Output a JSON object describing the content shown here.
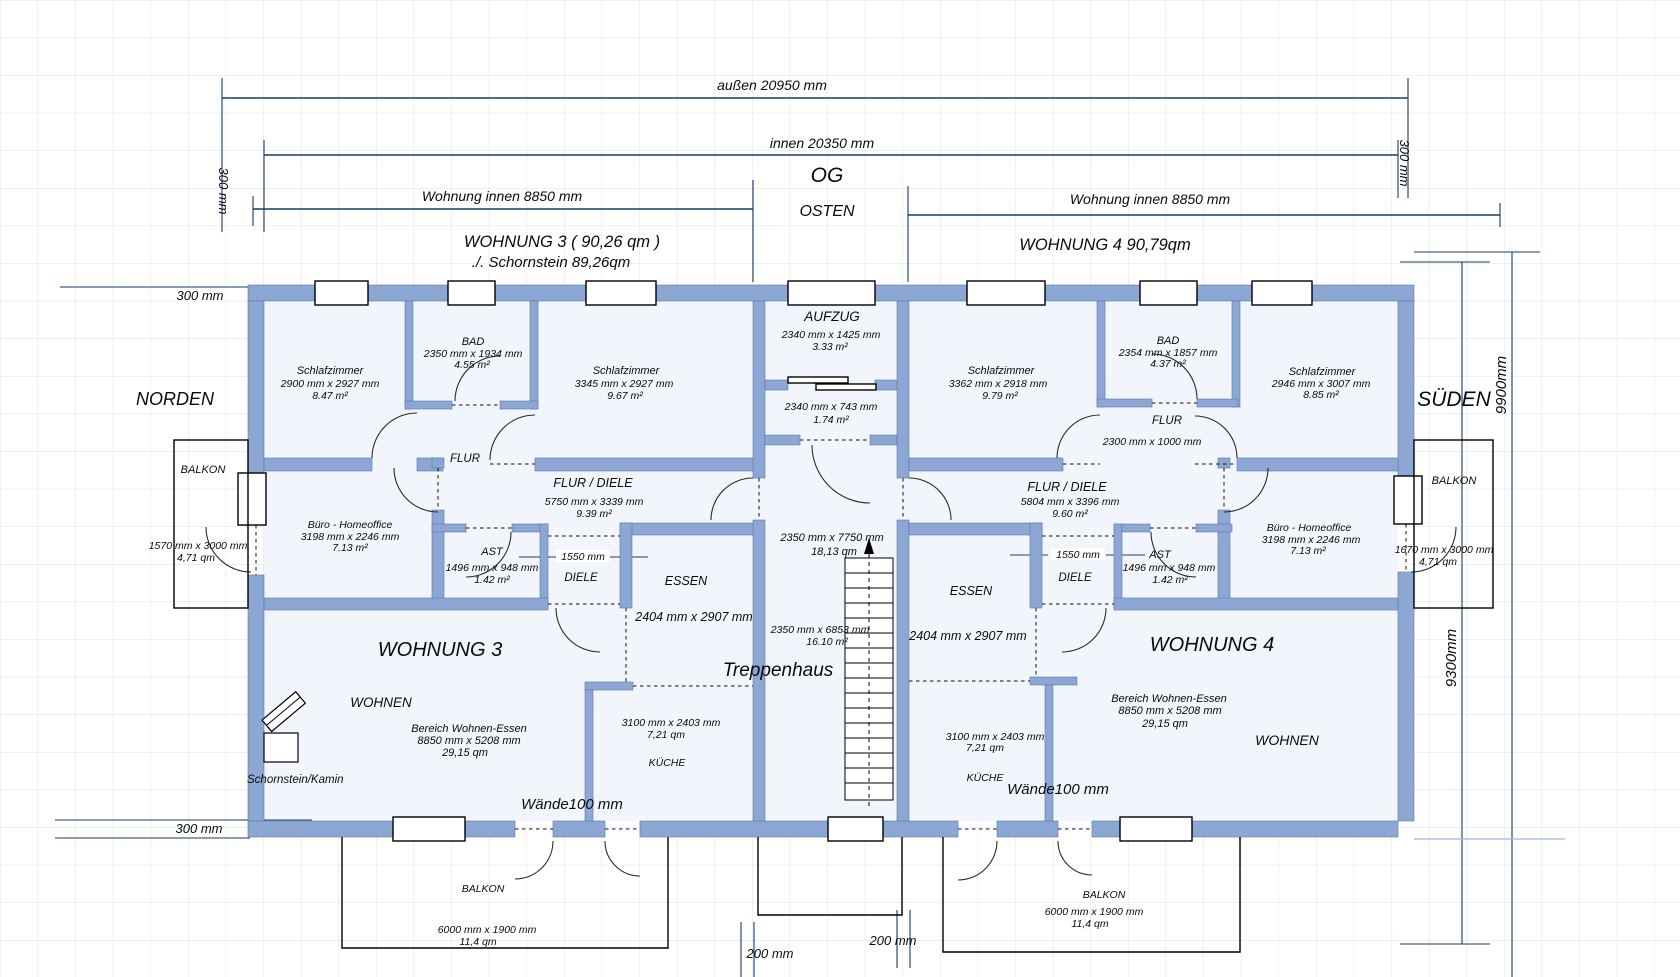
{
  "header": {
    "outer_width": "außen 20950 mm",
    "inner_width": "innen  20350 mm",
    "floor": "OG",
    "east": "OSTEN",
    "north": "NORDEN",
    "south": "SÜDEN",
    "apartment_inner_left": "Wohnung innen 8850 mm",
    "apartment_inner_right": "Wohnung innen 8850 mm",
    "apt3_title": "WOHNUNG   3    ( 90,26 qm )",
    "apt3_subtitle": "./.  Schornstein    89,26qm",
    "apt4_title": "WOHNUNG  4    90,79qm",
    "wall_300_left": "300 mm",
    "wall_300_right": "300 mm",
    "wall_300_topleft": "300 mm",
    "wall_300_bottomleft": "300 mm",
    "total_height": "9900mm",
    "inner_height": "9300mm"
  },
  "core": {
    "elevator": {
      "name": "AUFZUG",
      "size": "2340 mm x 1425 mm",
      "area": "3.33 m²"
    },
    "shaft": {
      "size": "2340 mm x 743 mm",
      "area": "1.74 m²"
    },
    "stairwell": {
      "name": "Treppenhaus",
      "size_outer": "2350 mm x 7750 mm",
      "area_outer": "18,13 qm",
      "size_inner": "2350 mm x 6853 mm",
      "area_inner": "16.10 m²"
    },
    "gap_left": "200 mm",
    "gap_right": "200 mm"
  },
  "apt3": {
    "name": "WOHNUNG 3",
    "bedroom1": {
      "name": "Schlafzimmer",
      "size": "2900 mm x 2927 mm",
      "area": "8.47 m²"
    },
    "bath": {
      "name": "BAD",
      "size": "2350 mm x 1934 mm",
      "area": "4.55 m²"
    },
    "bedroom2": {
      "name": "Schlafzimmer",
      "size": "3345 mm x 2927 mm",
      "area": "9.67 m²"
    },
    "hall": {
      "name": "FLUR"
    },
    "hall_diele": {
      "name": "FLUR / DIELE",
      "size": "5750 mm x 3339 mm",
      "area": "9.39 m²"
    },
    "office": {
      "name": "Büro - Homeoffice",
      "size": "3198 mm x 2246 mm",
      "area": "7.13 m²"
    },
    "ast": {
      "name": "AST",
      "size": "1496 mm x 948 mm",
      "area": "1.42 m²"
    },
    "diele": {
      "name": "DIELE",
      "width": "1550 mm"
    },
    "dining": {
      "name": "ESSEN",
      "size": "2404 mm x 2907 mm"
    },
    "living": {
      "name": "WOHNEN"
    },
    "living_area": {
      "name": "Bereich Wohnen-Essen",
      "size": "8850 mm x 5208 mm",
      "area": "29,15 qm"
    },
    "kitchen": {
      "name": "KÜCHE",
      "size": "3100 mm x 2403 mm",
      "area": "7,21 qm"
    },
    "walls_note": "Wände100 mm",
    "chimney": "Schornstein/Kamin",
    "balcony_side": {
      "name": "BALKON",
      "size": "1570 mm x 3000 mm",
      "area": "4,71 qm"
    },
    "balcony_bottom": {
      "name": "BALKON",
      "size": "6000 mm x 1900 mm",
      "area": "11,4 qm"
    }
  },
  "apt4": {
    "name": "WOHNUNG 4",
    "bedroom1": {
      "name": "Schlafzimmer",
      "size": "3362 mm x 2918 mm",
      "area": "9.79 m²"
    },
    "bath": {
      "name": "BAD",
      "size": "2354 mm x 1857 mm",
      "area": "4.37 m²"
    },
    "bedroom2": {
      "name": "Schlafzimmer",
      "size": "2946 mm x 3007 mm",
      "area": "8.85 m²"
    },
    "hall": {
      "name": "FLUR",
      "size": "2300 mm x 1000 mm"
    },
    "hall_diele": {
      "name": "FLUR / DIELE",
      "size": "5804 mm x 3396 mm",
      "area": "9.60 m²"
    },
    "office": {
      "name": "Büro - Homeoffice",
      "size": "3198 mm x 2246 mm",
      "area": "7.13 m²"
    },
    "ast": {
      "name": "AST",
      "size": "1496 mm x 948 mm",
      "area": "1.42 m²"
    },
    "diele": {
      "name": "DIELE",
      "width": "1550 mm"
    },
    "dining": {
      "name": "ESSEN",
      "size": "2404 mm x 2907 mm"
    },
    "living": {
      "name": "WOHNEN"
    },
    "living_area": {
      "name": "Bereich Wohnen-Essen",
      "size": "8850 mm x 5208 mm",
      "area": "29,15 qm"
    },
    "kitchen": {
      "name": "KÜCHE",
      "size": "3100 mm x 2403 mm",
      "area": "7,21 qm"
    },
    "walls_note": "Wände100 mm",
    "balcony_side": {
      "name": "BALKON",
      "size": "1670 mm x 3000 mm",
      "area": "4,71 qm"
    },
    "balcony_bottom": {
      "name": "BALKON",
      "size": "6000 mm x 1900 mm",
      "area": "11,4 qm"
    }
  }
}
